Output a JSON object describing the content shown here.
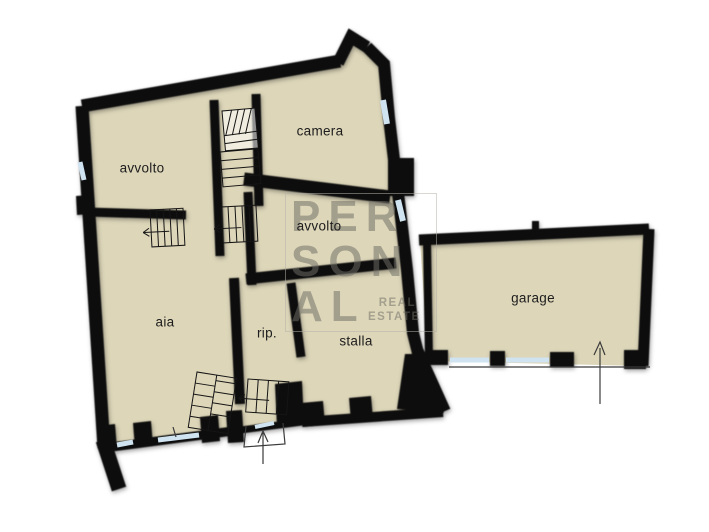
{
  "plan": {
    "name": "floor-plan"
  },
  "rooms": [
    {
      "id": "avvolto-nw",
      "label": "avvolto",
      "cx": 142,
      "cy": 168
    },
    {
      "id": "camera",
      "label": "camera",
      "cx": 320,
      "cy": 131
    },
    {
      "id": "avvolto-center",
      "label": "avvolto",
      "cx": 319,
      "cy": 226
    },
    {
      "id": "aia",
      "label": "aia",
      "cx": 165,
      "cy": 322
    },
    {
      "id": "rip",
      "label": "rip.",
      "cx": 267,
      "cy": 333
    },
    {
      "id": "stalla",
      "label": "stalla",
      "cx": 356,
      "cy": 341
    },
    {
      "id": "garage",
      "label": "garage",
      "cx": 533,
      "cy": 298
    }
  ],
  "watermark": {
    "line1": "PER",
    "line2": "SON",
    "line3": "AL",
    "sub1": "REAL",
    "sub2": "ESTATE"
  },
  "colors": {
    "background": "#ffffff",
    "floor": "#ddd6b9",
    "wall": "#0d0d0d",
    "window": "#cfe3f0",
    "watermark": "#6f6e66",
    "label": "#1d1d1d",
    "thin_line": "#3a3a3a"
  }
}
